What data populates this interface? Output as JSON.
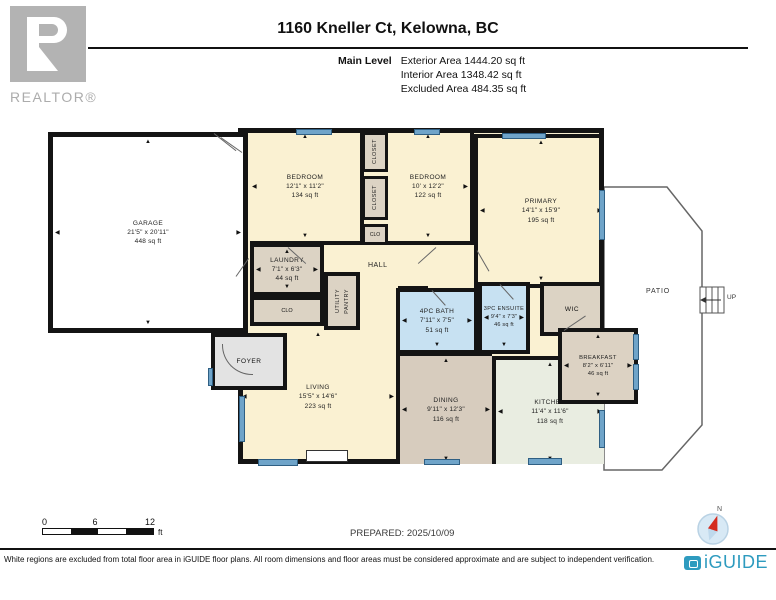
{
  "header": {
    "title": "1160 Kneller Ct, Kelowna, BC",
    "level_label": "Main Level",
    "stats": [
      "Exterior Area 1444.20 sq ft",
      "Interior Area 1348.42 sq ft",
      "Excluded Area 484.35 sq ft"
    ],
    "realtor_logo": "REALTOR®"
  },
  "rooms": {
    "garage": {
      "name": "GARAGE",
      "dims": "21'5\" x 20'11\"",
      "area": "448 sq ft"
    },
    "bedroom1": {
      "name": "BEDROOM",
      "dims": "12'1\" x 11'2\"",
      "area": "134 sq ft"
    },
    "bedroom2": {
      "name": "BEDROOM",
      "dims": "10' x 12'2\"",
      "area": "122 sq ft"
    },
    "primary": {
      "name": "PRIMARY",
      "dims": "14'1\" x 15'9\"",
      "area": "195 sq ft"
    },
    "laundry": {
      "name": "LAUNDRY",
      "dims": "7'1\" x 6'3\"",
      "area": "44 sq ft"
    },
    "bath4": {
      "name": "4PC BATH",
      "dims": "7'11\" x 7'5\"",
      "area": "51 sq ft"
    },
    "ensuite": {
      "name": "3PC ENSUITE",
      "dims": "9'4\" x 7'3\"",
      "area": "46 sq ft"
    },
    "living": {
      "name": "LIVING",
      "dims": "15'5\" x 14'6\"",
      "area": "223 sq ft"
    },
    "dining": {
      "name": "DINING",
      "dims": "9'11\" x 12'3\"",
      "area": "116 sq ft"
    },
    "kitchen": {
      "name": "KITCHEN",
      "dims": "11'4\" x 11'6\"",
      "area": "118 sq ft"
    },
    "breakfast": {
      "name": "BREAKFAST",
      "dims": "8'2\" x 6'11\"",
      "area": "46 sq ft"
    },
    "wic": {
      "name": "WIC"
    },
    "foyer": {
      "name": "FOYER"
    },
    "hall": {
      "name": "HALL"
    },
    "patio": {
      "name": "PATIO"
    },
    "closet_top": {
      "name": "CLOSET"
    },
    "closet_mid": {
      "name": "CLOSET"
    },
    "clo_small": {
      "name": "CLO"
    },
    "clo_laundry": {
      "name": "CLO"
    },
    "clo_hall": {
      "name": "CLO"
    },
    "utility": {
      "name": "UTILITY"
    },
    "pantry": {
      "name": "PANTRY"
    },
    "stairs_up": {
      "name": "UP"
    }
  },
  "scale": {
    "t0": "0",
    "t6": "6",
    "t12": "12",
    "unit": "ft"
  },
  "prepared": "PREPARED: 2025/10/09",
  "compass": {
    "north": "N"
  },
  "footer": {
    "disclaimer": "White regions are excluded from total floor area in iGUIDE floor plans. All room dimensions and floor areas must be considered approximate and are subject to independent verification.",
    "brand": "iGUIDE"
  },
  "colors": {
    "wall": "#141414",
    "room_cream": "#FAF1D2",
    "room_tan": "#DCD3C4",
    "room_blue": "#C7E1F2",
    "room_kitchen": "#E9EDE1",
    "window_blue": "#6FA4C9",
    "brand_teal": "#2E9BBF"
  }
}
